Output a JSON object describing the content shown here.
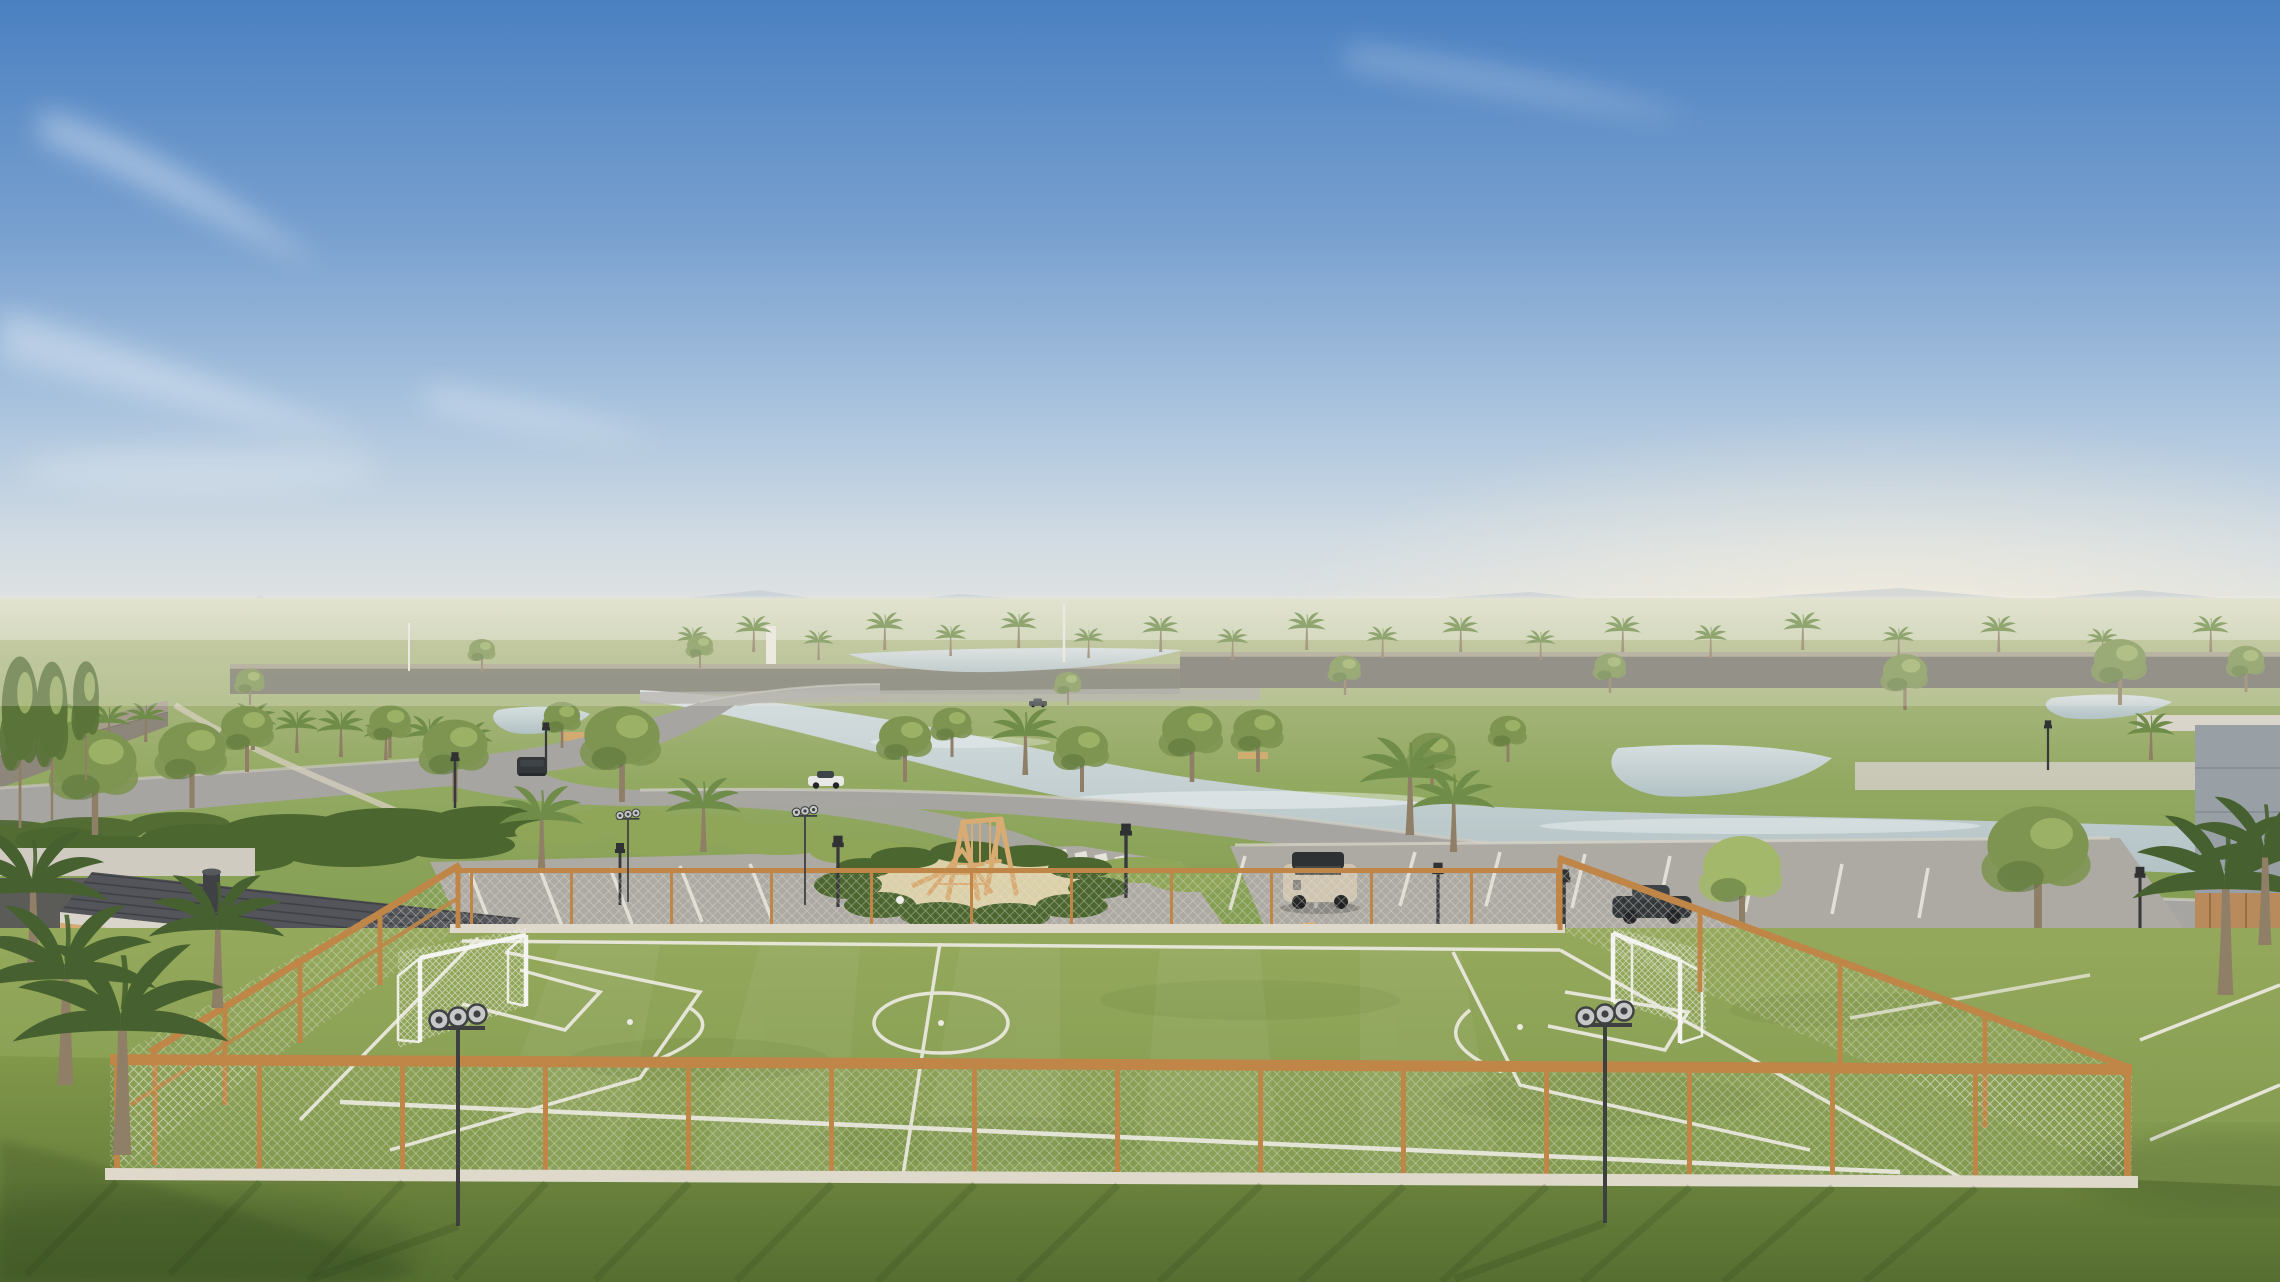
{
  "palette": {
    "sky_top": "#4a80c1",
    "sky_mid": "#78a0cf",
    "sky_low": "#a9c3de",
    "sky_haze": "#d2dce3",
    "horizon": "#efe9df",
    "cloud": "#ffffff",
    "mountain": "#b4c0cb",
    "sun_glow": "#fff3da",
    "far_field_light": "#dcdfc9",
    "far_field": "#a6b67c",
    "grass_top": "#b2bc8b",
    "grass_mid": "#92a961",
    "grass_deep": "#7f9b4e",
    "field_light": "#95a95c",
    "field_dark": "#7a9449",
    "lawn_light": "#81984a",
    "lawn_dark": "#566f31",
    "water_light": "#d6dedf",
    "water": "#b2c2c5",
    "road": "#a6a5a1",
    "road_dark": "#97968f",
    "paver": "#adaaa4",
    "paver_dark": "#8e8c86",
    "line_white": "#eceae2",
    "curb": "#ded9cb",
    "wall_light": "#a59c8d",
    "wall_dark": "#7a746c",
    "wall_far": "#6e6c66",
    "wood": "#bf8648",
    "wood_light": "#d8ab72",
    "roof_dark": "#53555a",
    "fascia": "#d9d5ca",
    "concrete": "#cfcbc0",
    "building_white": "#eae7df",
    "building_shadow": "#c9c5bb",
    "building_wood": "#b98a5c",
    "glass_dark": "#3e4347",
    "stone_blue": "#99a0a5",
    "canopy": "#7e9552",
    "canopy_light": "#a3b86b",
    "canopy_dark": "#5a7338",
    "palm": "#6f8c49",
    "palm_dark": "#46602f",
    "trunk": "#8f7f66",
    "sand": "#dcd0a8",
    "shrub_dark": "#4c6630",
    "shrub_light": "#8fa558",
    "metal_dark": "#3d3f41",
    "light_head": "#c7c9c8",
    "car_dark": "#33373a",
    "car_white": "#e8e8e6",
    "car_beige": "#cfc4b0",
    "mesh_line": "#e4e2d6",
    "net_white": "#f2f2ee",
    "shadow": "#2c401b"
  },
  "instances": {
    "houses": [
      {
        "sym": "h-bar",
        "x": 142,
        "y": 757,
        "s": 1.2,
        "sy": 1.1
      },
      {
        "sym": "h-two",
        "x": 336,
        "y": 756,
        "s": 1.9,
        "sy": 1.06
      },
      {
        "sym": "h-wood",
        "x": 598,
        "y": 745,
        "s": 1.45,
        "sy": 1.05
      },
      {
        "sym": "h-bar",
        "x": 812,
        "y": 700,
        "s": 1.75,
        "sy": 1.0
      },
      {
        "sym": "h-wood",
        "x": 938,
        "y": 695,
        "s": 0.8,
        "sy": 0.65
      },
      {
        "sym": "h-bar",
        "x": 612,
        "y": 690,
        "s": 0.5,
        "sy": 0.45
      },
      {
        "sym": "h-white",
        "x": 1040,
        "y": 690,
        "s": 1.5,
        "sy": 0.85
      },
      {
        "sym": "h-white",
        "x": 1368,
        "y": 700,
        "s": 1.15,
        "sy": 0.8
      },
      {
        "sym": "h-two",
        "x": 1518,
        "y": 706,
        "s": 0.95,
        "sy": 0.85
      },
      {
        "sym": "h-bar",
        "x": 1752,
        "y": 712,
        "s": 0.85,
        "sy": 0.75
      },
      {
        "sym": "h-two",
        "x": 1925,
        "y": 722,
        "s": 1.55,
        "sy": 0.92
      }
    ],
    "trees": [
      {
        "x": 250,
        "y": 705,
        "s": 0.55
      },
      {
        "x": 482,
        "y": 672,
        "s": 0.5
      },
      {
        "x": 700,
        "y": 668,
        "s": 0.5
      },
      {
        "x": 1068,
        "y": 705,
        "s": 0.5
      },
      {
        "x": 1345,
        "y": 695,
        "s": 0.6
      },
      {
        "x": 1610,
        "y": 693,
        "s": 0.6
      },
      {
        "x": 1905,
        "y": 710,
        "s": 0.85
      },
      {
        "x": 2120,
        "y": 705,
        "s": 1.0
      },
      {
        "x": 2246,
        "y": 692,
        "s": 0.7
      },
      {
        "x": 60,
        "y": 762,
        "s": 0.9
      },
      {
        "x": 247,
        "y": 772,
        "s": 1.0
      },
      {
        "x": 390,
        "y": 758,
        "s": 0.8
      },
      {
        "x": 562,
        "y": 748,
        "s": 0.7
      },
      {
        "x": 95,
        "y": 835,
        "s": 1.6
      },
      {
        "x": 192,
        "y": 808,
        "s": 1.3
      },
      {
        "x": 455,
        "y": 802,
        "s": 1.25
      },
      {
        "x": 622,
        "y": 802,
        "s": 1.45
      },
      {
        "x": 905,
        "y": 782,
        "s": 1.0
      },
      {
        "x": 952,
        "y": 757,
        "s": 0.75
      },
      {
        "x": 1082,
        "y": 792,
        "s": 1.0
      },
      {
        "x": 1192,
        "y": 782,
        "s": 1.15
      },
      {
        "x": 1258,
        "y": 772,
        "s": 0.95
      },
      {
        "x": 1432,
        "y": 792,
        "s": 0.9
      },
      {
        "x": 1508,
        "y": 762,
        "s": 0.7
      },
      {
        "x": 1742,
        "y": 935,
        "s": 1.5,
        "c": "palette.canopy_light"
      },
      {
        "x": 2038,
        "y": 935,
        "s": 1.95
      },
      {
        "x": 20,
        "y": 828,
        "s": 0.7,
        "sy": 2.6,
        "c": "palette.canopy_dark"
      },
      {
        "x": 52,
        "y": 820,
        "s": 0.6,
        "sy": 2.4,
        "c": "palette.canopy_dark"
      },
      {
        "x": 86,
        "y": 780,
        "s": 0.5,
        "sy": 1.8,
        "c": "palette.canopy_dark"
      }
    ],
    "palms_far": [
      {
        "x": 692,
        "y": 658,
        "s": 0.4
      },
      {
        "x": 753,
        "y": 652,
        "s": 0.46
      },
      {
        "x": 818,
        "y": 660,
        "s": 0.38
      },
      {
        "x": 884,
        "y": 650,
        "s": 0.48
      },
      {
        "x": 950,
        "y": 656,
        "s": 0.4
      },
      {
        "x": 1018,
        "y": 648,
        "s": 0.46
      },
      {
        "x": 1088,
        "y": 658,
        "s": 0.38
      },
      {
        "x": 1160,
        "y": 652,
        "s": 0.46
      },
      {
        "x": 1232,
        "y": 660,
        "s": 0.4
      },
      {
        "x": 1306,
        "y": 650,
        "s": 0.48
      },
      {
        "x": 1382,
        "y": 658,
        "s": 0.4
      },
      {
        "x": 1460,
        "y": 652,
        "s": 0.46
      },
      {
        "x": 1540,
        "y": 660,
        "s": 0.38
      },
      {
        "x": 1622,
        "y": 652,
        "s": 0.46
      },
      {
        "x": 1710,
        "y": 658,
        "s": 0.42
      },
      {
        "x": 1802,
        "y": 650,
        "s": 0.48
      },
      {
        "x": 1898,
        "y": 658,
        "s": 0.4
      },
      {
        "x": 1998,
        "y": 652,
        "s": 0.46
      },
      {
        "x": 2102,
        "y": 660,
        "s": 0.4
      },
      {
        "x": 2210,
        "y": 652,
        "s": 0.46
      },
      {
        "x": 75,
        "y": 752,
        "s": 0.6
      },
      {
        "x": 108,
        "y": 748,
        "s": 0.55
      },
      {
        "x": 145,
        "y": 742,
        "s": 0.5
      },
      {
        "x": 252,
        "y": 750,
        "s": 0.6
      },
      {
        "x": 296,
        "y": 753,
        "s": 0.55
      },
      {
        "x": 340,
        "y": 757,
        "s": 0.6
      },
      {
        "x": 385,
        "y": 760,
        "s": 0.55
      },
      {
        "x": 428,
        "y": 763,
        "s": 0.6
      },
      {
        "x": 470,
        "y": 765,
        "s": 0.55
      }
    ],
    "palms_mid": [
      {
        "x": 540,
        "y": 868,
        "s": 1.05
      },
      {
        "x": 702,
        "y": 852,
        "s": 0.95
      },
      {
        "x": 1024,
        "y": 775,
        "s": 0.85
      },
      {
        "x": 1408,
        "y": 835,
        "s": 1.25
      },
      {
        "x": 1452,
        "y": 852,
        "s": 1.05
      },
      {
        "x": 2150,
        "y": 760,
        "s": 0.6
      }
    ],
    "palms_fg": [
      {
        "x": 30,
        "y": 980,
        "s": 1.9,
        "c": "palette.palm_dark"
      },
      {
        "x": 215,
        "y": 1008,
        "s": 1.7,
        "c": "palette.palm_dark"
      },
      {
        "x": 62,
        "y": 1085,
        "s": 2.3,
        "c": "palette.palm_dark"
      },
      {
        "x": 118,
        "y": 1155,
        "s": 2.7,
        "c": "palette.palm_dark"
      },
      {
        "x": 2222,
        "y": 995,
        "s": 2.3,
        "c": "palette.palm_dark"
      },
      {
        "x": 2262,
        "y": 945,
        "s": 1.9,
        "c": "palette.palm_dark"
      }
    ],
    "lamps": [
      {
        "x": 455,
        "y": 808,
        "s": 0.9
      },
      {
        "x": 546,
        "y": 772,
        "s": 0.8
      },
      {
        "x": 620,
        "y": 905,
        "s": 1.0
      },
      {
        "x": 838,
        "y": 907,
        "s": 1.15
      },
      {
        "x": 1126,
        "y": 898,
        "s": 1.2
      },
      {
        "x": 1438,
        "y": 934,
        "s": 1.15
      },
      {
        "x": 1564,
        "y": 950,
        "s": 1.3
      },
      {
        "x": 2048,
        "y": 770,
        "s": 0.8
      },
      {
        "x": 2140,
        "y": 935,
        "s": 1.1
      }
    ],
    "masts": [
      {
        "x": 409,
        "y": 671,
        "s": 1.0
      },
      {
        "x": 1064,
        "y": 662,
        "s": 1.2
      }
    ],
    "floods_far": [
      {
        "x": 805,
        "y": 905,
        "s": 0.45
      },
      {
        "x": 628,
        "y": 902,
        "s": 0.42
      }
    ],
    "cars": [
      {
        "sym": "car",
        "x": 1038,
        "y": 706,
        "s": 0.5,
        "c": "palette.car_dark",
        "n": "car-distant"
      },
      {
        "sym": "car",
        "x": 826,
        "y": 786,
        "s": 1.0,
        "c": "palette.car_white",
        "n": "car-white-sedan"
      },
      {
        "sym": "suv",
        "x": 532,
        "y": 776,
        "s": 1.0,
        "c": "palette.car_dark",
        "n": "car-dark-suv"
      },
      {
        "sym": "car",
        "x": 1652,
        "y": 918,
        "s": 2.2,
        "c": "palette.car_dark",
        "n": "car-dark-sedan"
      }
    ]
  }
}
